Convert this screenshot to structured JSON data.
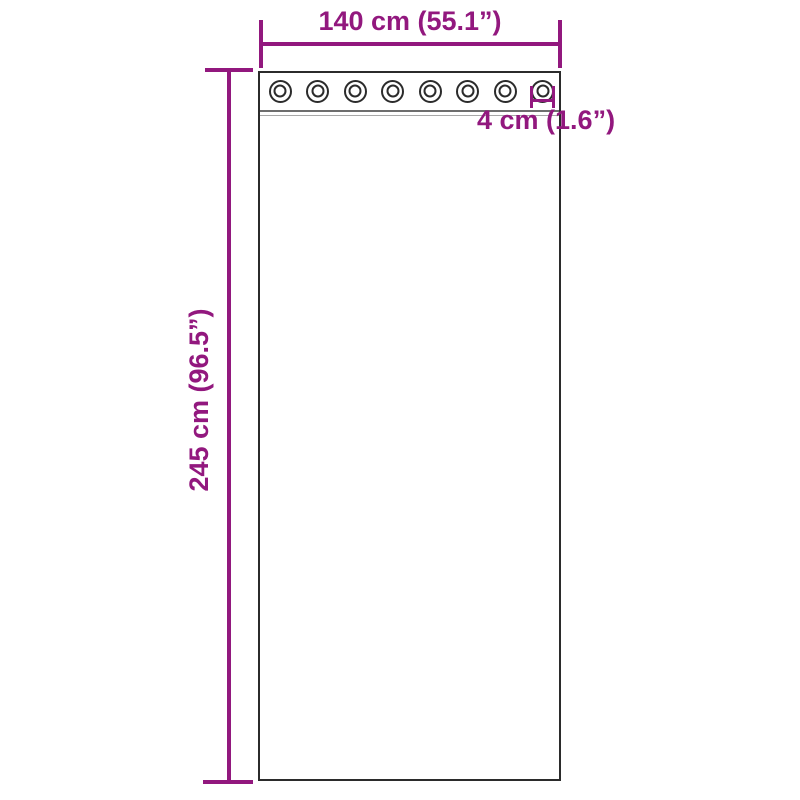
{
  "diagram": {
    "kind": "product-dimension-diagram",
    "subject": "curtain panel with grommets",
    "background_color": "#ffffff"
  },
  "colors": {
    "accent": "#92187e",
    "outline": "#2b2b2b",
    "seam_dark": "#6e6e6e",
    "seam_light": "#a8a8a8"
  },
  "curtain": {
    "grommet_count": 8
  },
  "dimensions": {
    "width": {
      "label": "140 cm (55.1”)"
    },
    "height": {
      "label": "245 cm (96.5”)"
    },
    "grommet_diameter": {
      "label": "4 cm (1.6”)"
    }
  }
}
